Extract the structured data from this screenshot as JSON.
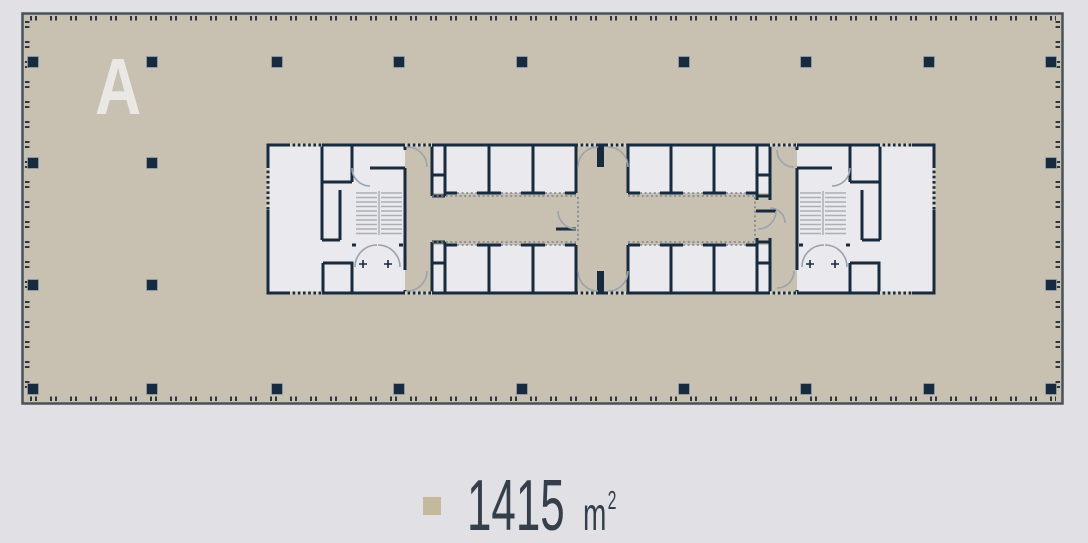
{
  "colors": {
    "page_bg": "#e1e0e5",
    "plan_fill": "#c8c1b2",
    "room_fill": "#e9e9ee",
    "wall": "#182a3d",
    "border": "#49525a",
    "tick": "#2e3740",
    "arc": "#9aa3ad",
    "stair": "#abb0b6",
    "dotted": "#7a828a",
    "dash_light": "#d8d3c6",
    "label": "#eae8e5",
    "text": "#343f4b",
    "bullet": "#c4b89d"
  },
  "plan": {
    "label": "A",
    "grid": {
      "rows": [
        {
          "y": 62,
          "x": [
            33,
            152,
            277,
            399,
            522,
            684,
            806,
            929,
            1051
          ]
        },
        {
          "y": 163,
          "x": [
            33,
            152,
            1051
          ]
        },
        {
          "y": 285,
          "x": [
            33,
            152,
            1051
          ]
        },
        {
          "y": 389,
          "x": [
            33,
            152,
            277,
            399,
            522,
            684,
            806,
            929,
            1051
          ]
        }
      ],
      "column_size": 11
    }
  },
  "caption": {
    "area_value": "1415",
    "area_unit_base": "m",
    "area_unit_exp": "2"
  }
}
